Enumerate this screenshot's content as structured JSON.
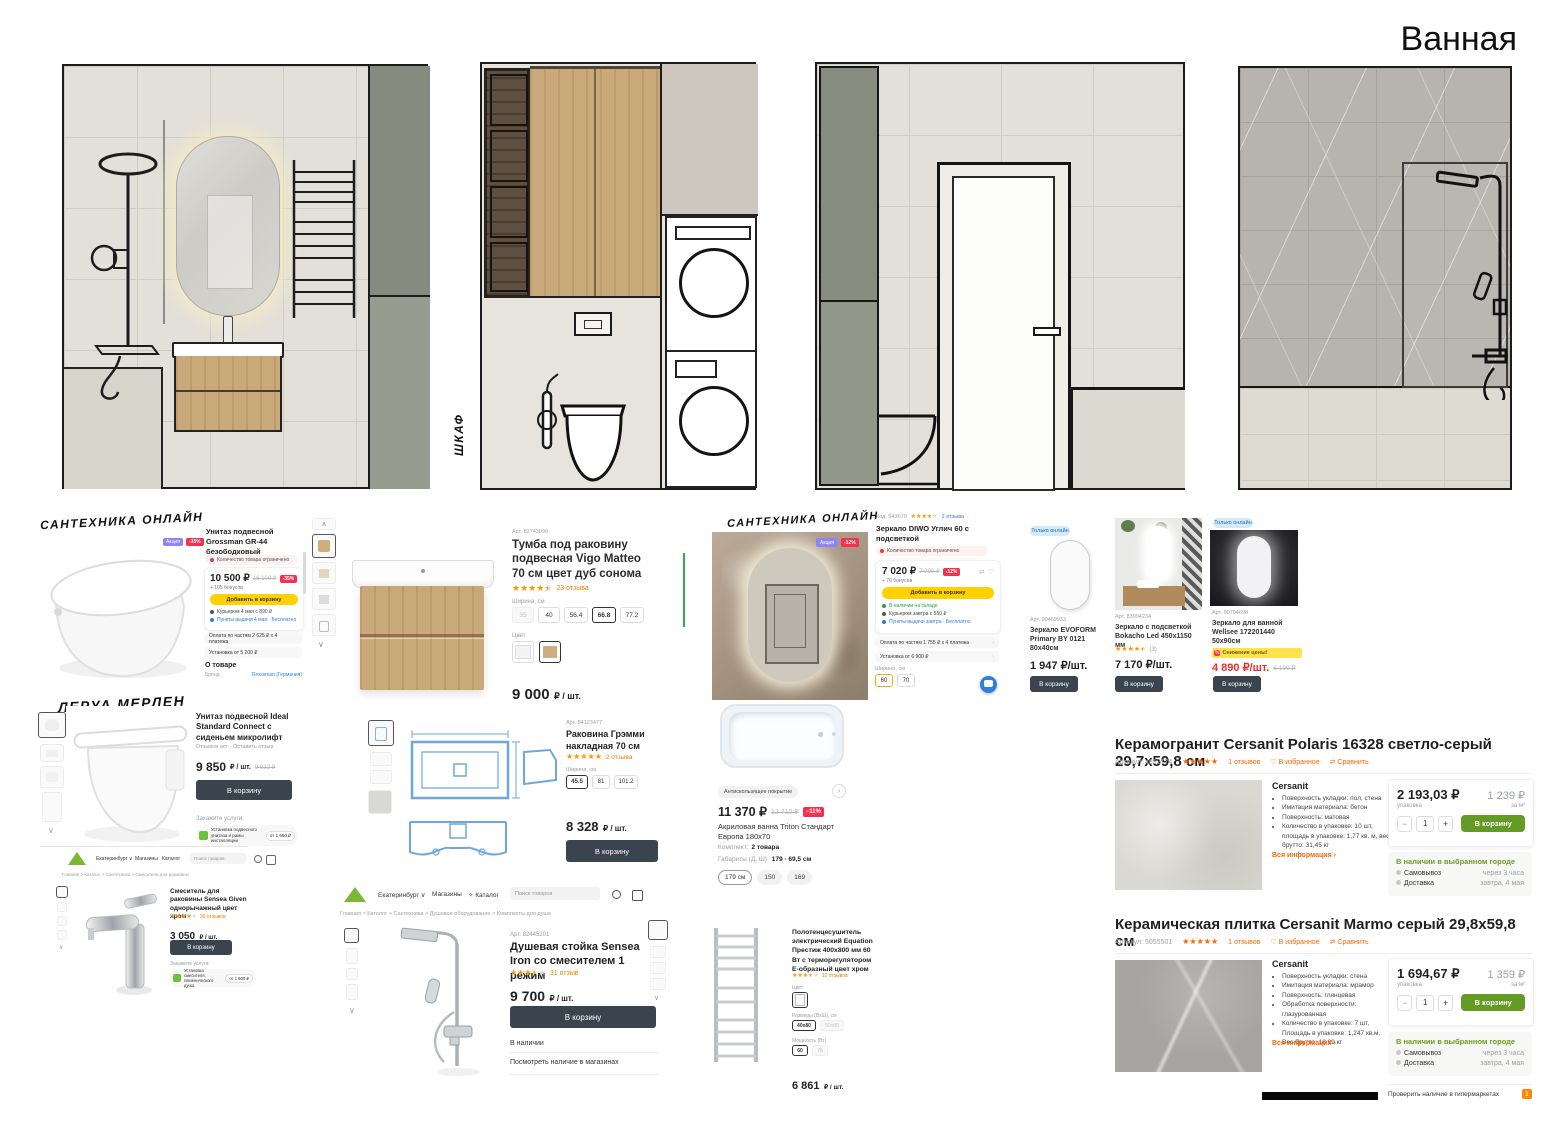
{
  "title": "Ванная",
  "elevations": {
    "cabinet_label": "ШКАФ"
  },
  "cards": {
    "toilet_grossman": {
      "shop": "САНТЕХНИКА ОНЛАЙН",
      "badge_promo": "Акция",
      "badge_discount": "-35%",
      "title": "Унитаз подвесной Grossman GR-44 безободковый",
      "stock_warning": "Количество товара ограничено",
      "price": "10 500 ₽",
      "old_price": "16 100 ₽",
      "discount": "-35%",
      "bonus": "+ 105 бонусов",
      "add_to_cart": "Добавить в корзину",
      "courier": "Курьером 4 мая с 890 ₽",
      "pickup": "Пункты выдачи 4 мая · Бесплатно",
      "installments": "Оплата по частям 2 625 ₽ х 4 платежа",
      "installation": "Установка от 5 200 ₽",
      "about": "О товаре",
      "brand_label": "Бренд",
      "brand": "Grossman (Германия)"
    },
    "vanity": {
      "art": "Арт. 82743090",
      "title": "Тумба под раковину подвесная Vigo Matteo 70 см цвет дуб сонома",
      "reviews": "23 отзыва",
      "width_label": "Ширина, см",
      "widths": [
        "35",
        "40",
        "56.4",
        "66.8",
        "77.2"
      ],
      "color_label": "Цвет",
      "price": "9 000",
      "price_unit": "₽ / шт."
    },
    "mirror_diwo": {
      "shop": "САНТЕХНИКА ОНЛАЙН",
      "code": "Код: 543679",
      "reviews": "2 отзыва",
      "title": "Зеркало DIWO Углич 60 с подсветкой",
      "stock_warning": "Количество товара ограничено",
      "price": "7 020 ₽",
      "old_price": "7 990 ₽",
      "discount": "-12%",
      "bonus": "+ 70 бонусов",
      "add_to_cart": "Добавить в корзину",
      "in_stock": "В наличии на складе",
      "courier": "Курьером завтра с 550 ₽",
      "pickup": "Пункты выдачи завтра · Бесплатно",
      "installments": "Оплата по частям 1 755 ₽ х 4 платежа",
      "installation": "Установка от 6 900 ₽",
      "width_label": "Ширина, см",
      "widths": [
        "60",
        "70"
      ],
      "badge_promo": "Акция",
      "badge_discount": "-12%"
    },
    "mirror_evoform": {
      "online_badge": "Только онлайн",
      "art": "Арт. 90469933",
      "title": "Зеркало EVOFORM Primary BY 0121 80x40см",
      "price": "1 947 ₽/шт.",
      "button": "В корзину"
    },
    "mirror_bokacho": {
      "art": "Арт. 83994234",
      "title": "Зеркало с подсветкой Bokacho Led 450x1150 мм",
      "reviews": "(3)",
      "price": "7 170 ₽/шт.",
      "button": "В корзину"
    },
    "mirror_wellsee": {
      "online_badge": "Только онлайн",
      "art": "Арт. 90704698",
      "title": "Зеркало для ванной Wellsee 172201440 50x90см",
      "sale_chip": "Снижение цены!",
      "price": "4 890 ₽/шт.",
      "old_price": "6 190 ₽",
      "button": "В корзину"
    },
    "toilet_ideal": {
      "shop": "ЛЕРУА МЕРЛЕН",
      "title": "Унитаз подвесной Ideal Standard Connect с сиденьем микролифт",
      "reviews": "Отзывов нет · Оставить отзыв",
      "price": "9 850",
      "price_unit": "₽ / шт.",
      "old_price": "9 932 ₽",
      "button": "В корзину",
      "services_label": "Закажите услуги:",
      "service": "Установка подвесного унитаза и рамы инсталляции",
      "service_price": "от 1 650 ₽"
    },
    "sink": {
      "art": "Арт. 84123477",
      "title": "Раковина Грэмми накладная 70 см",
      "reviews": "2 отзыва",
      "width_label": "Ширина, см",
      "widths": [
        "45.5",
        "81",
        "101.2"
      ],
      "price": "8 328",
      "price_unit": "₽ / шт.",
      "button": "В корзину"
    },
    "bathtub": {
      "feature_chip": "Антискользящее покрытие",
      "price": "11 370 ₽",
      "old_price": "12 710 ₽",
      "discount": "−11%",
      "title": "Акриловая ванна Triton Стандарт Европа 180х70",
      "kit_label": "Комплект:",
      "kit": "2 товара",
      "dims_label": "Габариты (Д, Ш):",
      "dims": "179 · 69,5 см",
      "sizes": [
        "179 см",
        "150",
        "169"
      ]
    },
    "faucet": {
      "city": "Екатеринбург",
      "nav_stores": "Магазины",
      "nav_catalog": "Каталог",
      "search_placeholder": "Поиск товаров",
      "breadcrumb": "Главная > Каталог > Сантехника > Смесители для раковины",
      "title": "Смеситель для раковины Sensea Given однорычажный цвет хром",
      "reviews": "30 отзывов",
      "price": "3 050",
      "price_unit": "₽ / шт.",
      "button": "В корзину",
      "services_label": "Закажите услуги:",
      "service": "Установка смесителя, гигиенического душа",
      "service_price": "от 1 500 ₽"
    },
    "shower": {
      "city": "Екатеринбург",
      "nav_stores": "Магазины",
      "nav_catalog": "Каталог",
      "search_placeholder": "Поиск товаров",
      "breadcrumb": "Главная > Каталог > Сантехника > Душевое оборудование > Комплекты для душа",
      "art": "Арт. 82445201",
      "title": "Душевая стойка Sensea Iron со смесителем 1 режим",
      "reviews": "31 отзыв",
      "price": "9 700",
      "price_unit": "₽ / шт.",
      "button": "В корзину",
      "stock": "В наличии",
      "stores_link": "Посмотреть наличие в магазинах"
    },
    "towel": {
      "title": "Полотенцесушитель электрический Equation Престиж 400х800 мм 60 Вт с терморегулятором Е-образный цвет хром",
      "reviews": "12 отзывов",
      "color_label": "Цвет",
      "size_label": "Размеры (ВхШ), см",
      "sizes": [
        "40х80",
        "50х80"
      ],
      "power_label": "Мощность (Вт)",
      "powers": [
        "60",
        "75"
      ],
      "price": "6 861",
      "price_unit": "₽ / шт."
    },
    "tile_polaris": {
      "title": "Керамогранит Cersanit Polaris 16328 светло-серый 29,7x59,8 см",
      "sku": "Артикул: 4852174",
      "reviews": "1 отзывов",
      "fav": "В избранное",
      "compare": "Сравнить",
      "brand": "Cersanit",
      "bullets": [
        "Поверхность укладки: пол, стена",
        "Имитация материала: бетон",
        "Поверхность: матовая",
        "Количество в упаковке: 10 шт, площадь в упаковке: 1,77 кв. м, вес брутто: 31,45 кг"
      ],
      "more": "Вся информация ›",
      "pack_price": "2 193,03 ₽",
      "pack_label": "упаковка",
      "m2_price": "1 239 ₽",
      "m2_label": "за м²",
      "qty": "1",
      "button": "В корзину",
      "avail_heading": "В наличии в выбранном городе",
      "pickup_label": "Самовывоз",
      "pickup_value": "через 3 часа",
      "delivery_label": "Доставка",
      "delivery_value": "завтра, 4 мая"
    },
    "tile_marmo": {
      "title": "Керамическая плитка Cersanit Marmo серый 29,8x59,8 см",
      "sku": "Артикул: 5055501",
      "reviews": "1 отзывов",
      "fav": "В избранное",
      "compare": "Сравнить",
      "brand": "Cersanit",
      "bullets": [
        "Поверхность укладки: стена",
        "Имитация материала: мрамор",
        "Поверхность: глянцевая",
        "Обработка поверхности: глазурованная",
        "Количество в упаковке: 7 шт, Площадь в упаковке: 1,247 кв.м, Вес брутто: 18,99 кг"
      ],
      "more": "Вся информация ›",
      "pack_price": "1 694,67 ₽",
      "pack_label": "упаковка",
      "m2_price": "1 359 ₽",
      "m2_label": "за м²",
      "qty": "1",
      "button": "В корзину",
      "avail_heading": "В наличии в выбранном городе",
      "pickup_label": "Самовывоз",
      "pickup_value": "через 3 часа",
      "delivery_label": "Доставка",
      "delivery_value": "завтра, 4 мая",
      "check": "Проверить наличие в гипермаркетах",
      "check_badge": "1"
    }
  }
}
